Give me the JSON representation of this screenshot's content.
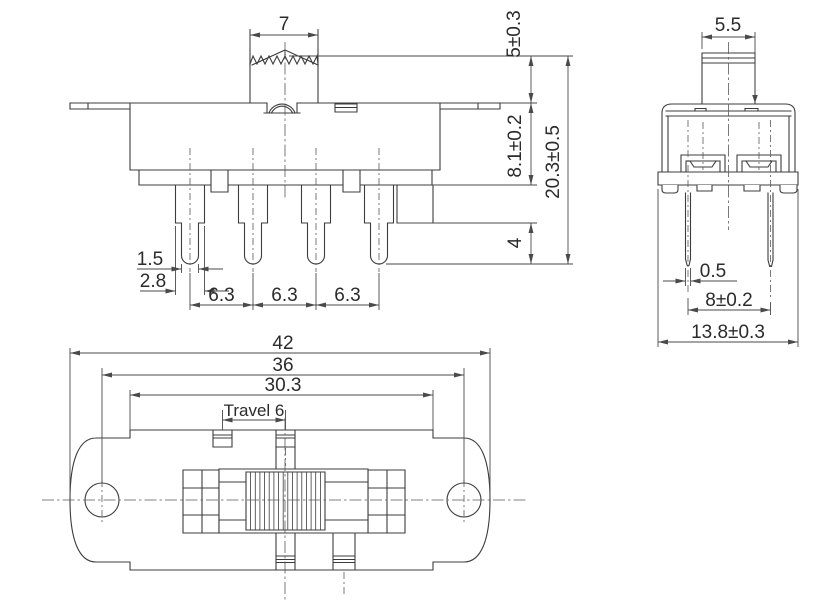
{
  "title": "Slide switch 3-view technical drawing",
  "front_view": {
    "knob_width": "7",
    "actuator_height": "5±0.3",
    "body_height": "8.1±0.2",
    "overall_height": "20.3±0.5",
    "terminal_tip_length": "4",
    "terminal_tip_width": "1.5",
    "terminal_width": "2.8",
    "terminal_pitch_1": "6.3",
    "terminal_pitch_2": "6.3",
    "terminal_pitch_3": "6.3"
  },
  "side_view": {
    "knob_width": "5.5",
    "terminal_thickness": "0.5",
    "terminal_row_spacing": "8±0.2",
    "body_depth": "13.8±0.3"
  },
  "top_view": {
    "overall_length": "42",
    "mounting_hole_spacing": "36",
    "cover_length": "30.3",
    "travel": "Travel 6"
  },
  "colors": {
    "line": "#3c3c3c",
    "background": "#ffffff"
  }
}
